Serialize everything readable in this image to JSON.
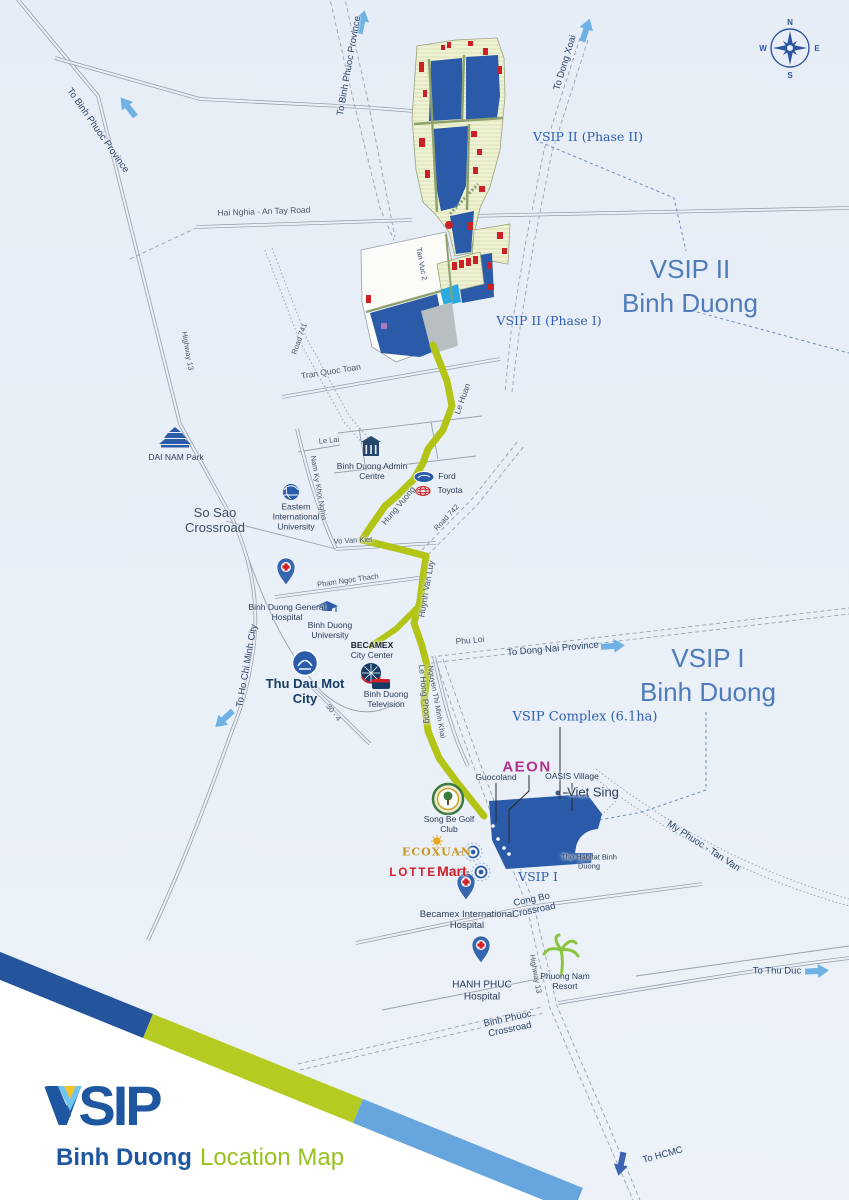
{
  "title": {
    "brand": "VSIP",
    "region_bold": "Binh Duong",
    "region_light": "Location Map"
  },
  "compass": {
    "north": "N",
    "east": "E",
    "south": "S",
    "west": "W"
  },
  "regions": {
    "vsip2_title": "VSIP II",
    "vsip2_subtitle": "Binh Duong",
    "vsip1_title": "VSIP I",
    "vsip1_subtitle": "Binh Duong",
    "vsip2_phase2": "VSIP II (Phase II)",
    "vsip2_phase1": "VSIP II (Phase I)",
    "vsip1_zone": "VSIP I",
    "vsip_complex": "VSIP Complex (6.1ha)"
  },
  "roads": {
    "to_binh_phuoc_province_n": "To Binh Phuoc Province",
    "to_binh_phuoc_province_w": "To Binh Phuoc Province",
    "to_dong_xoai": "To Dong Xoai",
    "hai_nghia_an_tay": "Hai Nghia - An Tay Road",
    "tan_vuc_2": "Tan Vuc 2",
    "road_741": "Road 741",
    "highway_13_north": "Highway 13",
    "tran_quoc_toan": "Tran Quoc Toan",
    "le_huan": "Le Huan",
    "le_lai": "Le Lai",
    "nam_ky_khoi_nghia": "Nam Ky Khoi Nghia",
    "vo_van_kiet": "Vo Van Kiet",
    "hung_vuong": "Hung Vuong",
    "road_742": "Road 742",
    "pham_ngoc_thach": "Pham Ngoc Thach",
    "huynh_van_luy": "Huynh Van Luy",
    "phu_loi": "Phu Loi",
    "road_30_4": "30 - 4",
    "le_hong_phong": "Le Hong Phong",
    "nguyen_thi_minh_khai": "Nguyen Thi Minh Khai",
    "my_phuoc_tan_van": "My Phuoc - Tan Van",
    "highway_13_south": "Highway 13",
    "so_sao_crossroad": "So Sao Crossroad",
    "cong_bo_crossroad": "Cong Bo Crossroad",
    "binh_phuoc_crossroad": "Binh Phuoc Crossroad",
    "to_dong_nai_province": "To Dong Nai Province",
    "to_ho_chi_minh_city": "To Ho Chi Minh City",
    "to_thu_duc": "To Thu Duc",
    "to_hcmc": "To HCMC"
  },
  "landmarks": {
    "dai_nam_park": "DAI NAM Park",
    "binh_duong_admin_centre": "Binh Duong Admin Centre",
    "ford": "Ford",
    "toyota": "Toyota",
    "eastern_international_university": "Eastern International University",
    "binh_duong_general_hospital": "Binh Duong General Hospital",
    "binh_duong_university": "Binh Duong University",
    "becamex": "BECAMEX",
    "becamex_sub": "City Center",
    "thu_dau_mot_city": "Thu Dau Mot City",
    "binh_duong_television": "Binh Duong Television",
    "aeon": "AEON",
    "guocoland": "Guocoland",
    "oasis_village": "OASIS Village",
    "viet_sing": "Viet Sing",
    "song_be_golf_club": "Song Be Golf Club",
    "ecoxuan": "ECOXUAN",
    "lotte": "LOTTE",
    "lotte_mart": "Mart",
    "the_habitat": "The Habitat Binh Duong",
    "becamex_international_hospital": "Becamex International Hospital",
    "hanh_phuc_hospital": "HANH PHUC Hospital",
    "phuong_nam_resort": "Phuong Nam Resort"
  },
  "colors": {
    "route_green": "#b2c516",
    "parcel_blue": "#2a5aa8",
    "brand_blue": "#1e56a0",
    "brand_green": "#97c11f",
    "label_blue": "#2e5fae",
    "arrow_light_blue": "#6fb1e4",
    "arrow_dark_blue": "#3b63b1",
    "lotte_red": "#d01f27",
    "ecoxuan_gold": "#c79a1e",
    "aeon_magenta": "#b0338d"
  }
}
